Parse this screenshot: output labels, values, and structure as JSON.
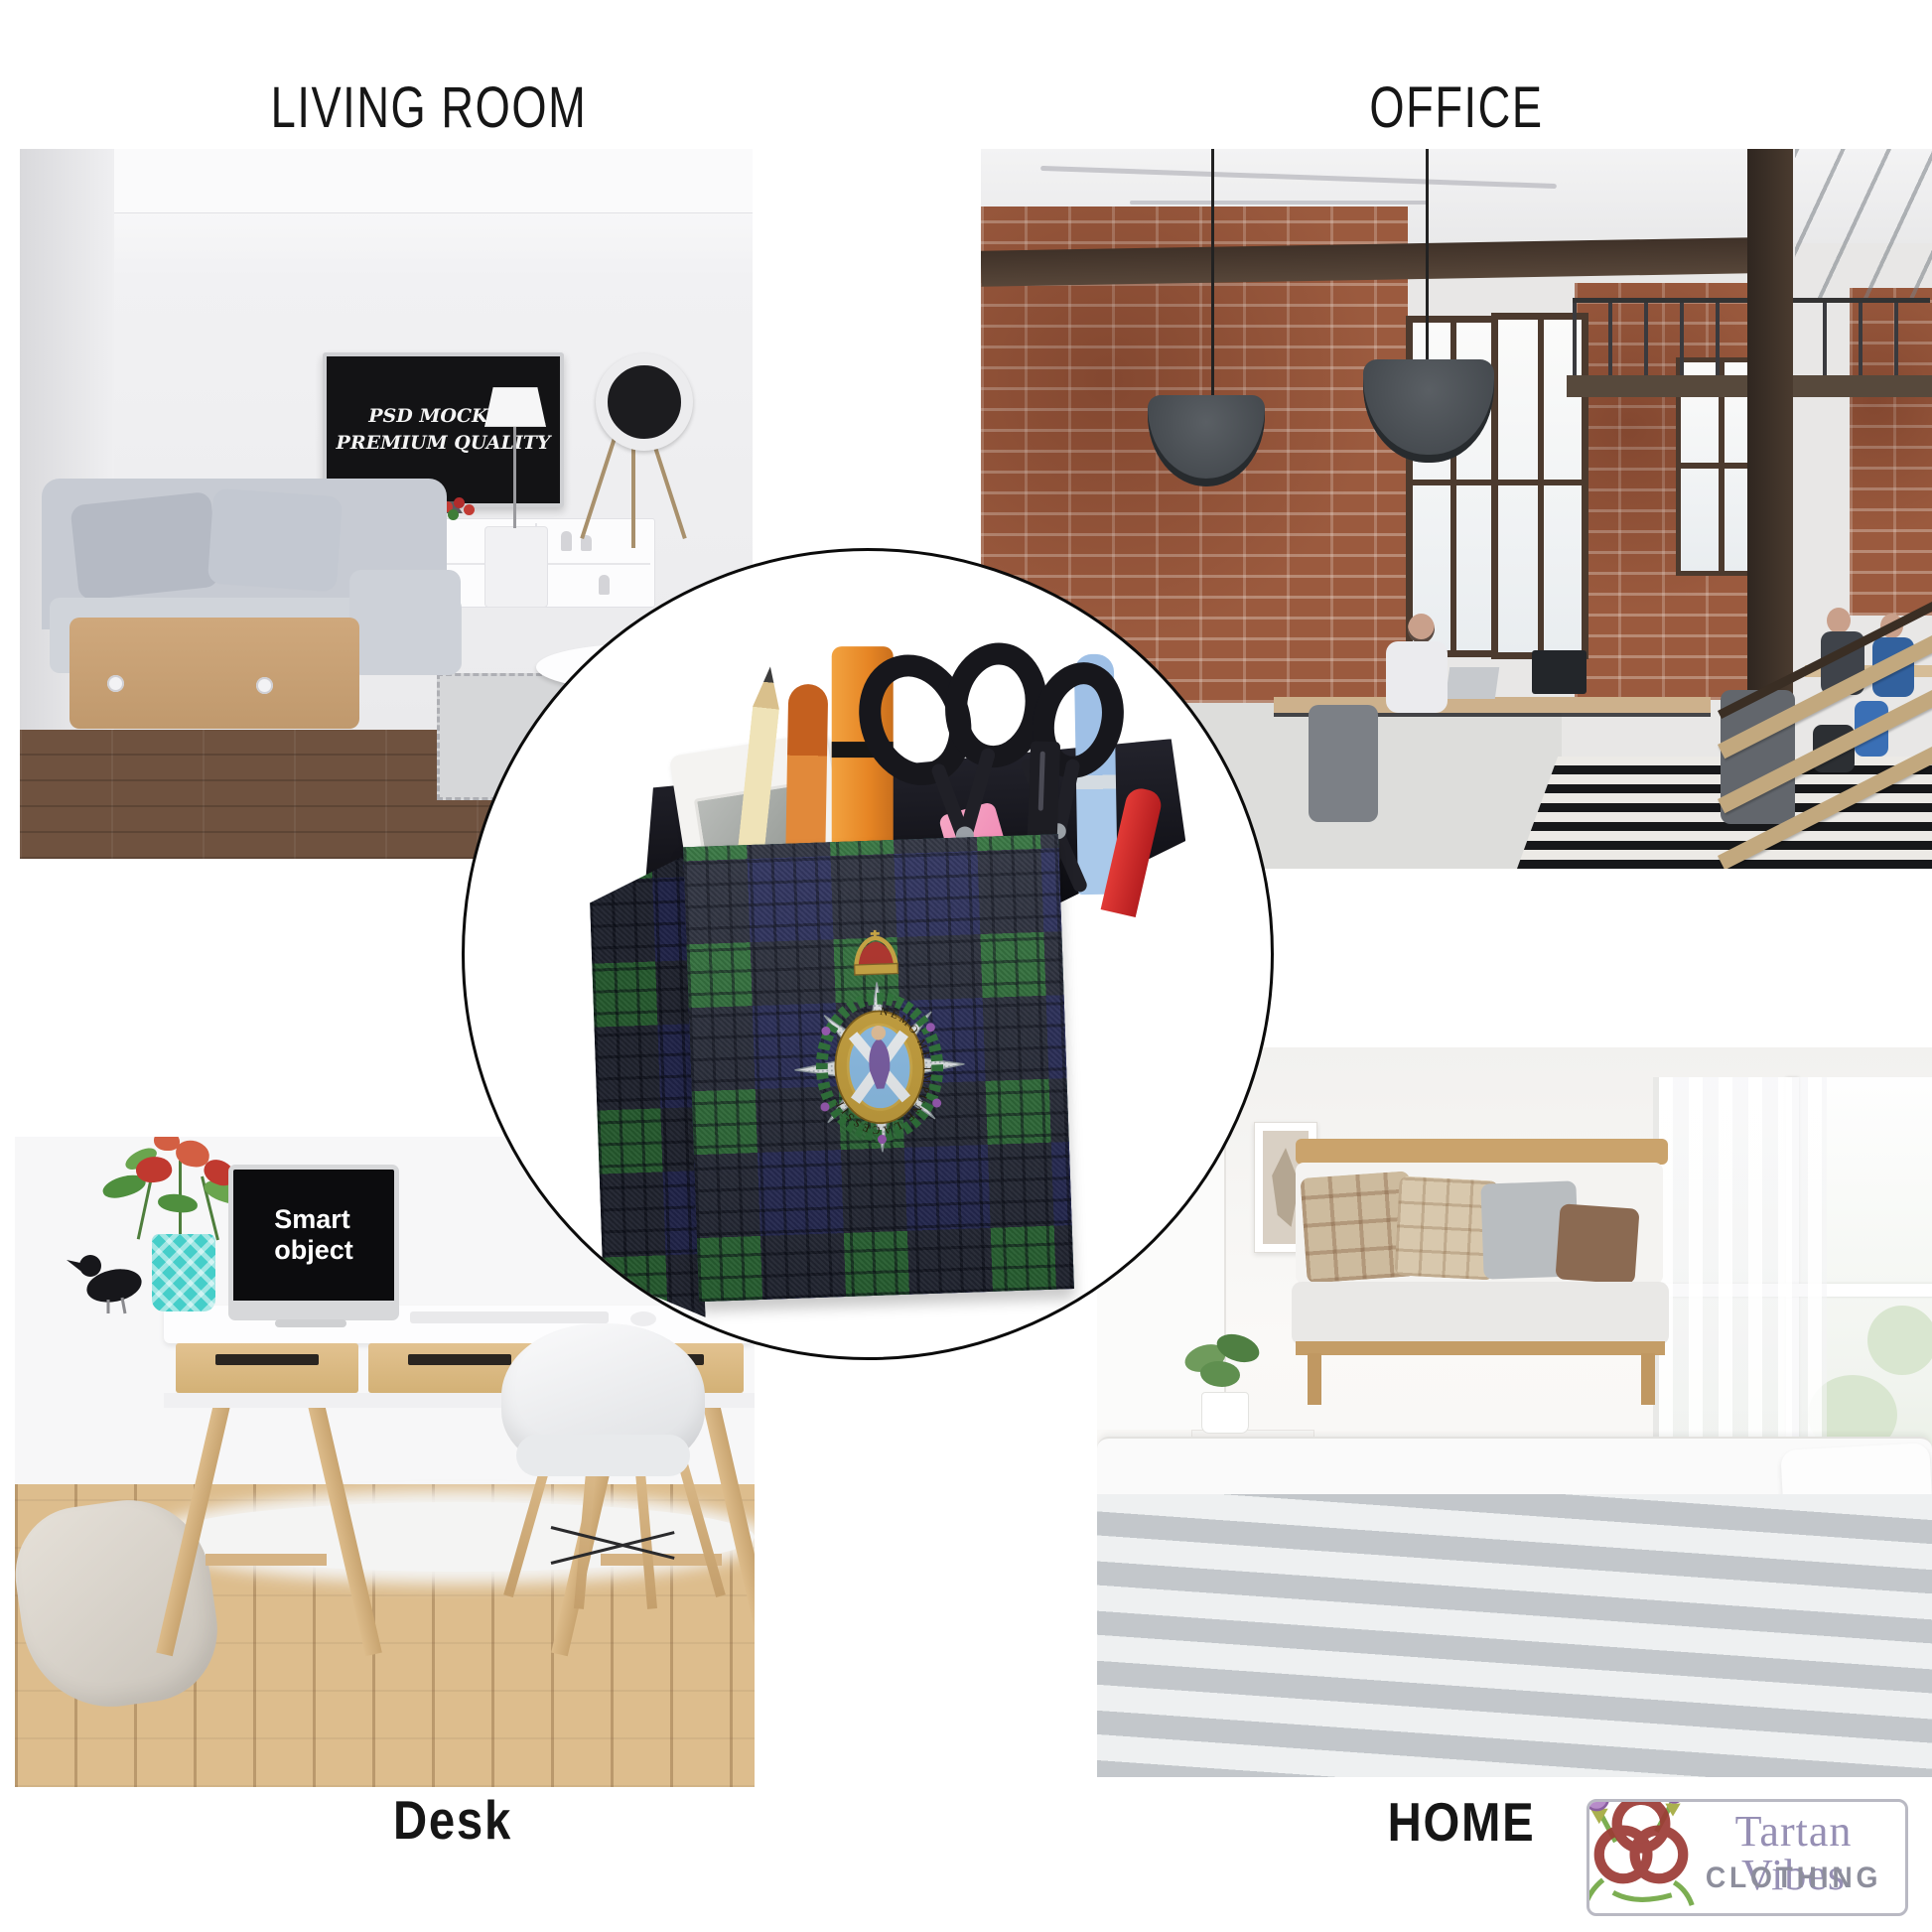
{
  "canvas": {
    "background": "#ffffff"
  },
  "sections": {
    "living_room": {
      "label": "LIVING ROOM",
      "tv": {
        "line1": "PSD MOCKUP",
        "line2": "PREMIUM QUALITY"
      }
    },
    "office": {
      "label": "OFFICE"
    },
    "desk": {
      "label": "Desk",
      "monitor": {
        "line1": "Smart",
        "line2": "object"
      }
    },
    "home": {
      "label": "HOME"
    }
  },
  "inset": {
    "description": "Black Watch tartan pencil holder with clan crest badge",
    "badge_motto": "NEMO ME IMPUNE LACESSIT"
  },
  "brand": {
    "name": "Tartan Vibes",
    "subtitle": "CLOTHING"
  },
  "colors": {
    "tartan_green": "#2e7039",
    "tartan_navy": "#272b59",
    "tartan_black": "#121420",
    "vase_teal": "#45cec9",
    "brand_name_color": "#968fb4",
    "brand_subtitle_color": "#8d8e9c"
  }
}
